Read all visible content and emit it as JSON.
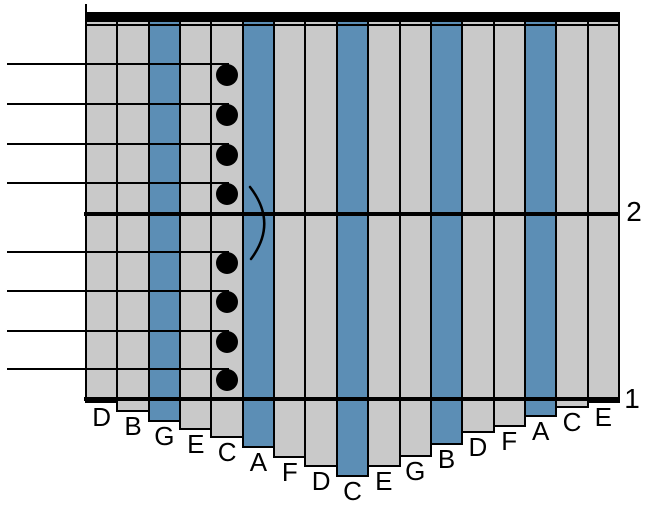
{
  "colors": {
    "background": "#FFFFFF",
    "tine_gray": "#C9C9C9",
    "tine_blue": "#5C8EB5",
    "ink": "#000000"
  },
  "diagram": {
    "type": "kalimba-tablature",
    "tines": [
      {
        "label": "D",
        "painted": false,
        "bottom": 403
      },
      {
        "label": "B",
        "painted": false,
        "bottom": 412
      },
      {
        "label": "G",
        "painted": true,
        "bottom": 422
      },
      {
        "label": "E",
        "painted": false,
        "bottom": 430
      },
      {
        "label": "C",
        "painted": false,
        "bottom": 438
      },
      {
        "label": "A",
        "painted": true,
        "bottom": 448
      },
      {
        "label": "F",
        "painted": false,
        "bottom": 458
      },
      {
        "label": "D",
        "painted": false,
        "bottom": 467
      },
      {
        "label": "C",
        "painted": true,
        "bottom": 477
      },
      {
        "label": "E",
        "painted": false,
        "bottom": 467
      },
      {
        "label": "G",
        "painted": false,
        "bottom": 457
      },
      {
        "label": "B",
        "painted": true,
        "bottom": 445
      },
      {
        "label": "D",
        "painted": false,
        "bottom": 433
      },
      {
        "label": "F",
        "painted": false,
        "bottom": 427
      },
      {
        "label": "A",
        "painted": true,
        "bottom": 417
      },
      {
        "label": "C",
        "painted": false,
        "bottom": 408
      },
      {
        "label": "E",
        "painted": false,
        "bottom": 403
      }
    ],
    "measures": [
      {
        "number": "2",
        "line_y": 212
      },
      {
        "number": "1",
        "line_y": 397
      }
    ],
    "notes": [
      {
        "tine": "C",
        "tine_index": 4,
        "line_y": 63
      },
      {
        "tine": "C",
        "tine_index": 4,
        "line_y": 103
      },
      {
        "tine": "C",
        "tine_index": 4,
        "line_y": 143
      },
      {
        "tine": "C",
        "tine_index": 4,
        "line_y": 182
      },
      {
        "tine": "C",
        "tine_index": 4,
        "line_y": 251
      },
      {
        "tine": "C",
        "tine_index": 4,
        "line_y": 290
      },
      {
        "tine": "C",
        "tine_index": 4,
        "line_y": 330
      },
      {
        "tine": "C",
        "tine_index": 4,
        "line_y": 368
      }
    ],
    "tie": {
      "from_note": 3,
      "to_note": 4
    }
  }
}
